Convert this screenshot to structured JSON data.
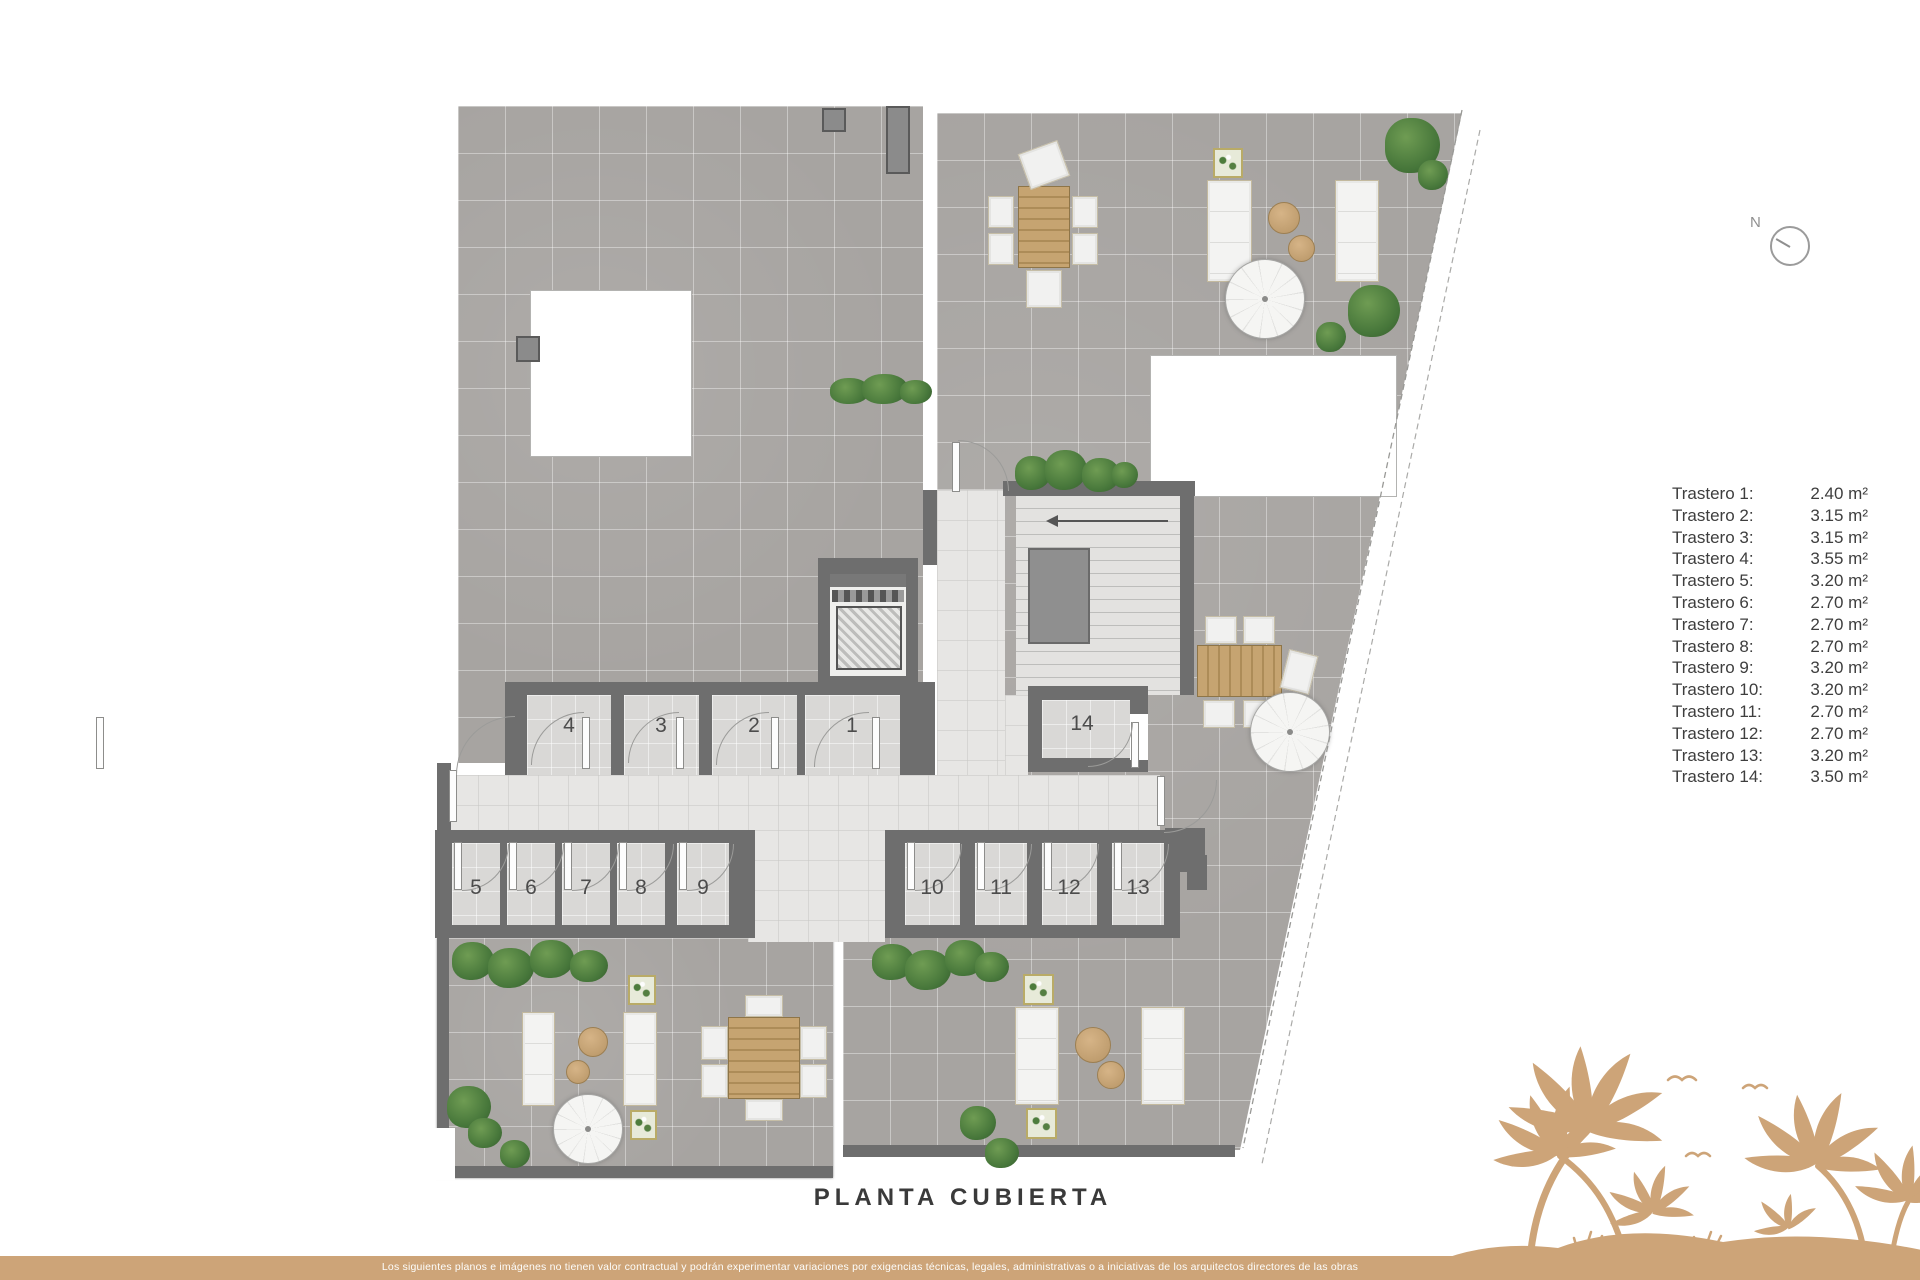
{
  "title": "PLANTA CUBIERTA",
  "compass": {
    "label": "N"
  },
  "legend": {
    "items": [
      {
        "name": "Trastero 1:",
        "area": "2.40 m²"
      },
      {
        "name": "Trastero 2:",
        "area": "3.15 m²"
      },
      {
        "name": "Trastero 3:",
        "area": "3.15 m²"
      },
      {
        "name": "Trastero 4:",
        "area": "3.55 m²"
      },
      {
        "name": "Trastero 5:",
        "area": "3.20 m²"
      },
      {
        "name": "Trastero 6:",
        "area": "2.70 m²"
      },
      {
        "name": "Trastero 7:",
        "area": "2.70 m²"
      },
      {
        "name": "Trastero 8:",
        "area": "2.70 m²"
      },
      {
        "name": "Trastero 9:",
        "area": "3.20 m²"
      },
      {
        "name": "Trastero 10:",
        "area": "3.20 m²"
      },
      {
        "name": "Trastero 11:",
        "area": "2.70 m²"
      },
      {
        "name": "Trastero 12:",
        "area": "2.70 m²"
      },
      {
        "name": "Trastero 13:",
        "area": "3.20 m²"
      },
      {
        "name": "Trastero 14:",
        "area": "3.50 m²"
      }
    ]
  },
  "plan": {
    "rooms": [
      {
        "label": "1"
      },
      {
        "label": "2"
      },
      {
        "label": "3"
      },
      {
        "label": "4"
      },
      {
        "label": "5"
      },
      {
        "label": "6"
      },
      {
        "label": "7"
      },
      {
        "label": "8"
      },
      {
        "label": "9"
      },
      {
        "label": "10"
      },
      {
        "label": "11"
      },
      {
        "label": "12"
      },
      {
        "label": "13"
      },
      {
        "label": "14"
      }
    ]
  },
  "footer": {
    "disclaimer": "Los siguientes planos e imágenes no tienen valor contractual y podrán experimentar variaciones por exigencias técnicas, legales, administrativas o a iniciativas de los arquitectos directores de las obras"
  },
  "colors": {
    "accent_tan": "#cda478",
    "wall_gray": "#6e6e6e",
    "tile_gray": "#a7a4a1"
  }
}
